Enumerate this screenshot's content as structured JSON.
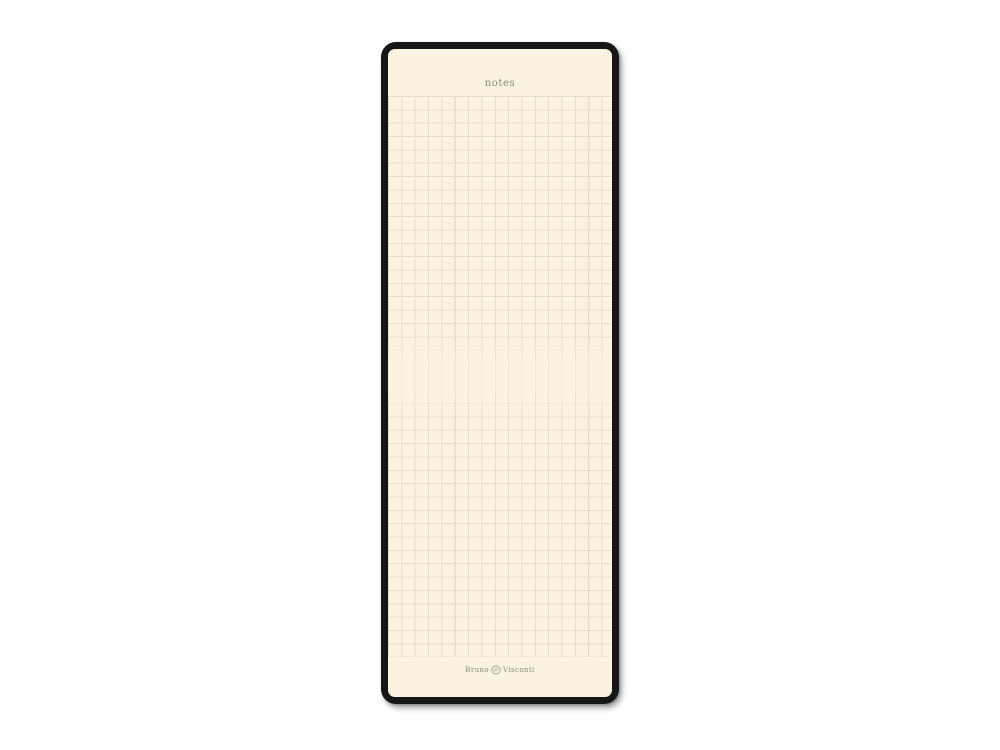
{
  "scene": {
    "background_color": "#ffffff",
    "description": "Product photo of a slim notepad with black cover frame and cream squared paper"
  },
  "notepad": {
    "header": {
      "title": "notes"
    },
    "footer": {
      "brand_left": "Bruno",
      "brand_right": "Visconti",
      "emblem_icon": "bv-laurel-crest-icon"
    },
    "colors": {
      "scene_bg": "#ffffff",
      "frame": "#161616",
      "paper": "#fbf3e2",
      "grid_line": "#e7dec8",
      "ink": "#8b8779",
      "brand_ink": "#8c887a"
    }
  }
}
